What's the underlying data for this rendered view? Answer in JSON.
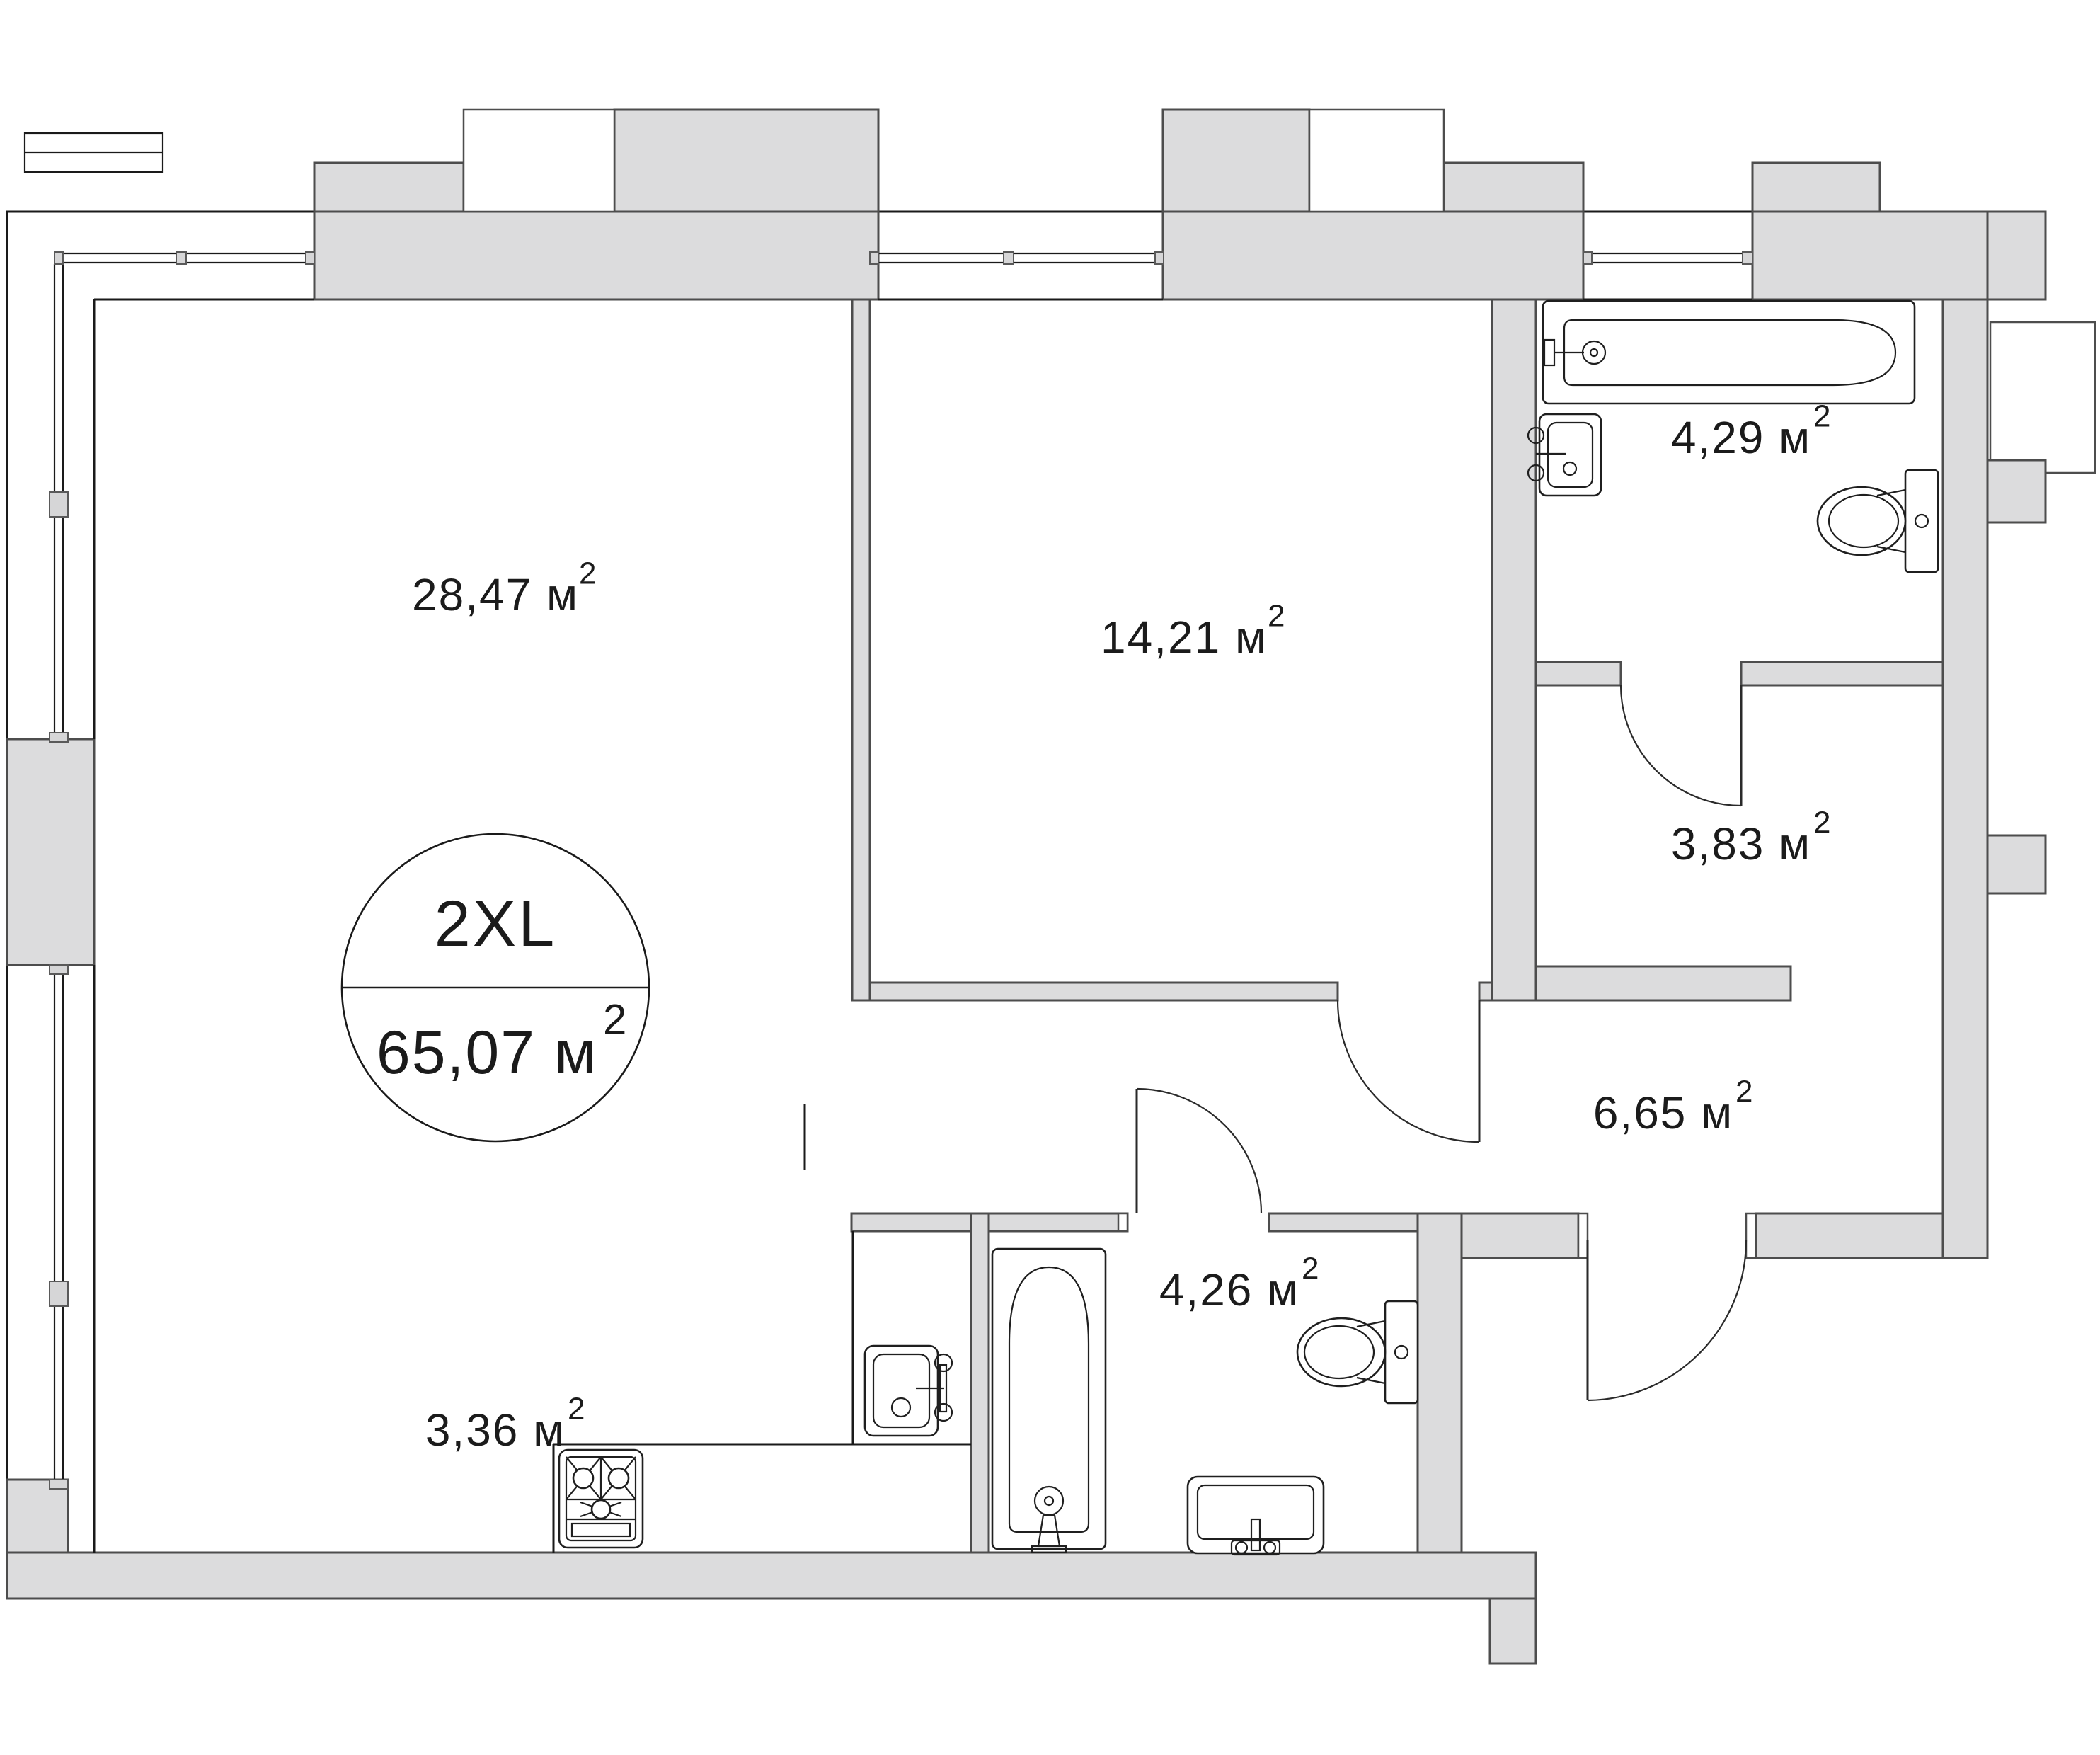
{
  "plan": {
    "badge": {
      "size_label": "2XL",
      "area_label": "65,07 м",
      "area_sup": "2"
    },
    "rooms": [
      {
        "name": "living-room",
        "label": "28,47 м",
        "sup": "2"
      },
      {
        "name": "bedroom",
        "label": "14,21 м",
        "sup": "2"
      },
      {
        "name": "bathroom-top",
        "label": "4,29 м",
        "sup": "2"
      },
      {
        "name": "hallway",
        "label": "3,83 м",
        "sup": "2"
      },
      {
        "name": "corridor",
        "label": "6,65 м",
        "sup": "2"
      },
      {
        "name": "bathroom-bottom",
        "label": "4,26 м",
        "sup": "2"
      },
      {
        "name": "kitchen",
        "label": "3,36 м",
        "sup": "2"
      }
    ],
    "colors": {
      "wall_fill": "#dcdcdd",
      "line": "#1a1a1a",
      "wall_stroke": "#4d4d4d",
      "text": "#1b1b1b",
      "background": "#ffffff"
    },
    "fixtures": [
      "bathtub-top",
      "sink-top-bathroom",
      "toilet-top",
      "bathtub-bottom",
      "sink-bottom-bathroom",
      "toilet-bottom",
      "kitchen-sink",
      "stove"
    ]
  }
}
